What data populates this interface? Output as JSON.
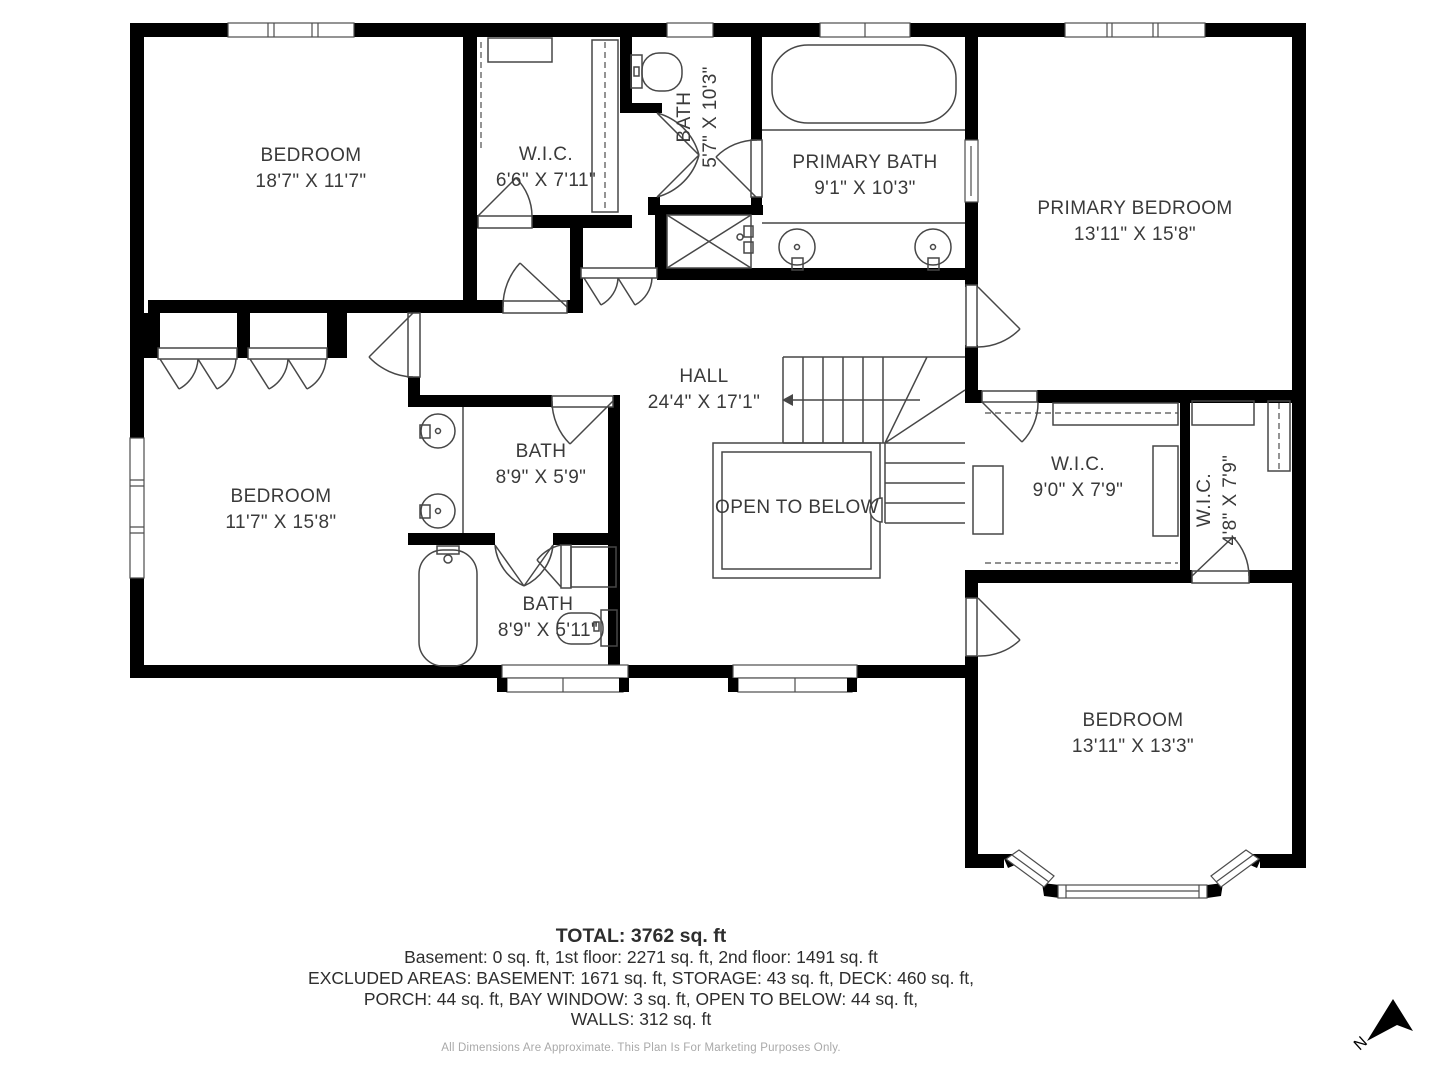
{
  "rooms": {
    "bedroom_top_left": {
      "name": "BEDROOM",
      "dims": "18'7\" X 11'7\""
    },
    "wic_top": {
      "name": "W.I.C.",
      "dims": "6'6\" X 7'11\""
    },
    "bath_top": {
      "name": "BATH",
      "dims": "5'7\" X 10'3\""
    },
    "primary_bath": {
      "name": "PRIMARY BATH",
      "dims": "9'1\" X 10'3\""
    },
    "primary_bedroom": {
      "name": "PRIMARY BEDROOM",
      "dims": "13'11\" X 15'8\""
    },
    "hall": {
      "name": "HALL",
      "dims": "24'4\" X 17'1\""
    },
    "bedroom_left": {
      "name": "BEDROOM",
      "dims": "11'7\" X 15'8\""
    },
    "bath_mid": {
      "name": "BATH",
      "dims": "8'9\" X 5'9\""
    },
    "open_to_below": {
      "name": "OPEN TO BELOW"
    },
    "wic_right": {
      "name": "W.I.C.",
      "dims": "9'0\" X 7'9\""
    },
    "wic_small": {
      "name": "W.I.C.",
      "dims": "4'8\" X 7'9\""
    },
    "bath_lower": {
      "name": "BATH",
      "dims": "8'9\" X 5'11\""
    },
    "bedroom_bottom": {
      "name": "BEDROOM",
      "dims": "13'11\" X 13'3\""
    }
  },
  "summary": {
    "total": "TOTAL: 3762 sq. ft",
    "floors": "Basement: 0 sq. ft, 1st floor: 2271 sq. ft, 2nd floor: 1491 sq. ft",
    "excluded_line1": "EXCLUDED AREAS: BASEMENT: 1671 sq. ft, STORAGE: 43 sq. ft, DECK: 460 sq. ft,",
    "excluded_line2": "PORCH: 44 sq. ft, BAY WINDOW: 3 sq. ft, OPEN TO BELOW: 44 sq. ft,",
    "excluded_line3": "WALLS: 312 sq. ft"
  },
  "footer": {
    "disclaimer": "All Dimensions Are Approximate. This Plan Is For Marketing Purposes Only."
  },
  "compass": {
    "north_label": "N"
  },
  "colors": {
    "wall": "#000000",
    "linework": "#474747",
    "label_text": "#3a3a3a",
    "disclaimer_text": "#a9a9a9"
  }
}
